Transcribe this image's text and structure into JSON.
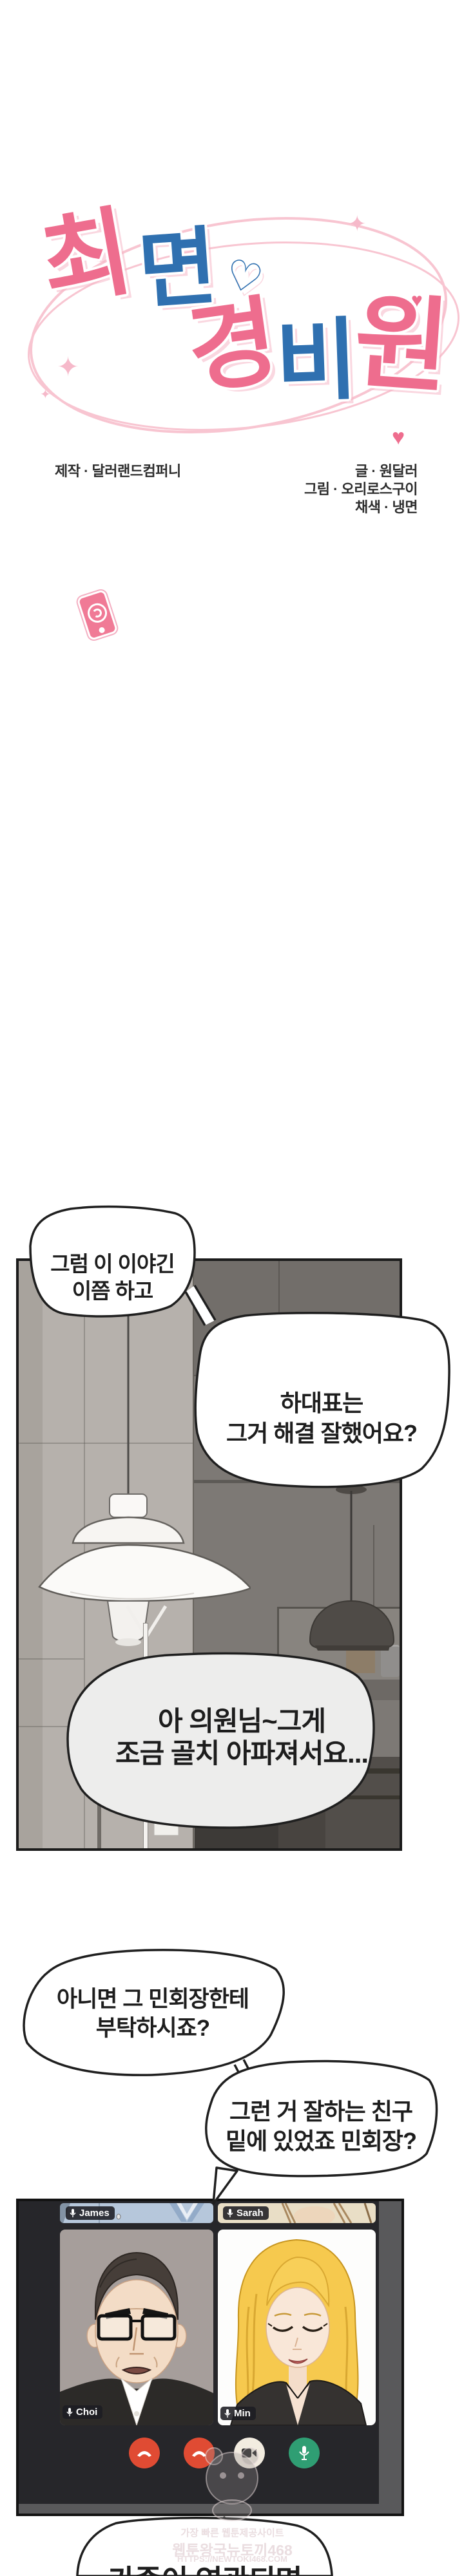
{
  "title": {
    "full": "최면 경비원",
    "row1": [
      {
        "ch": "최"
      },
      {
        "ch": "면"
      }
    ],
    "row2": [
      {
        "ch": "경"
      },
      {
        "ch": "비"
      },
      {
        "ch": "원"
      }
    ],
    "heart": "♡",
    "small_heart": "♥",
    "sparkle": "✦",
    "accent_pink": "#ee6d8e",
    "accent_blue": "#2f70b0",
    "swirl_pink": "#f8c5d1"
  },
  "credits": {
    "production": "제작 · 달러랜드컴퍼니",
    "writing": "글 · 원달러",
    "art": "그림 · 오리로스구이",
    "coloring": "채색 · 냉면"
  },
  "bubbles": {
    "b1": {
      "lines": [
        "그럼 이 이야긴",
        "이쯤 하고"
      ]
    },
    "b2": {
      "lines": [
        "하대표는",
        "그거 해결 잘했어요?"
      ]
    },
    "b3": {
      "lines": [
        "아 의원님~그게",
        "조금 골치 아파져서요..."
      ]
    },
    "b4": {
      "lines": [
        "아니면 그 민회장한테",
        "부탁하시죠?"
      ]
    },
    "b5": {
      "lines": [
        "그런 거 잘하는 친구",
        "밑에 있었죠 민회장?"
      ]
    },
    "b6": {
      "lines": [
        "가족이 연관되면"
      ]
    }
  },
  "video_call": {
    "participants": [
      {
        "name": "James"
      },
      {
        "name": "Sarah"
      },
      {
        "name": "Choi"
      },
      {
        "name": "Min"
      }
    ],
    "buttons": [
      {
        "icon": "hangup-icon",
        "color": "#e04b33"
      },
      {
        "icon": "hangup-icon",
        "color": "#e04b33"
      },
      {
        "icon": "camera-icon",
        "color": "#f2ece0"
      },
      {
        "icon": "microphone-icon",
        "color": "#2f9e73"
      }
    ]
  },
  "watermark": {
    "lines": [
      "가장 빠른 웹툰제공사이트",
      "웹툰왕국뉴토끼468",
      "HTTPS://NEWTOKI468.COM"
    ],
    "color": "#eadde0"
  }
}
